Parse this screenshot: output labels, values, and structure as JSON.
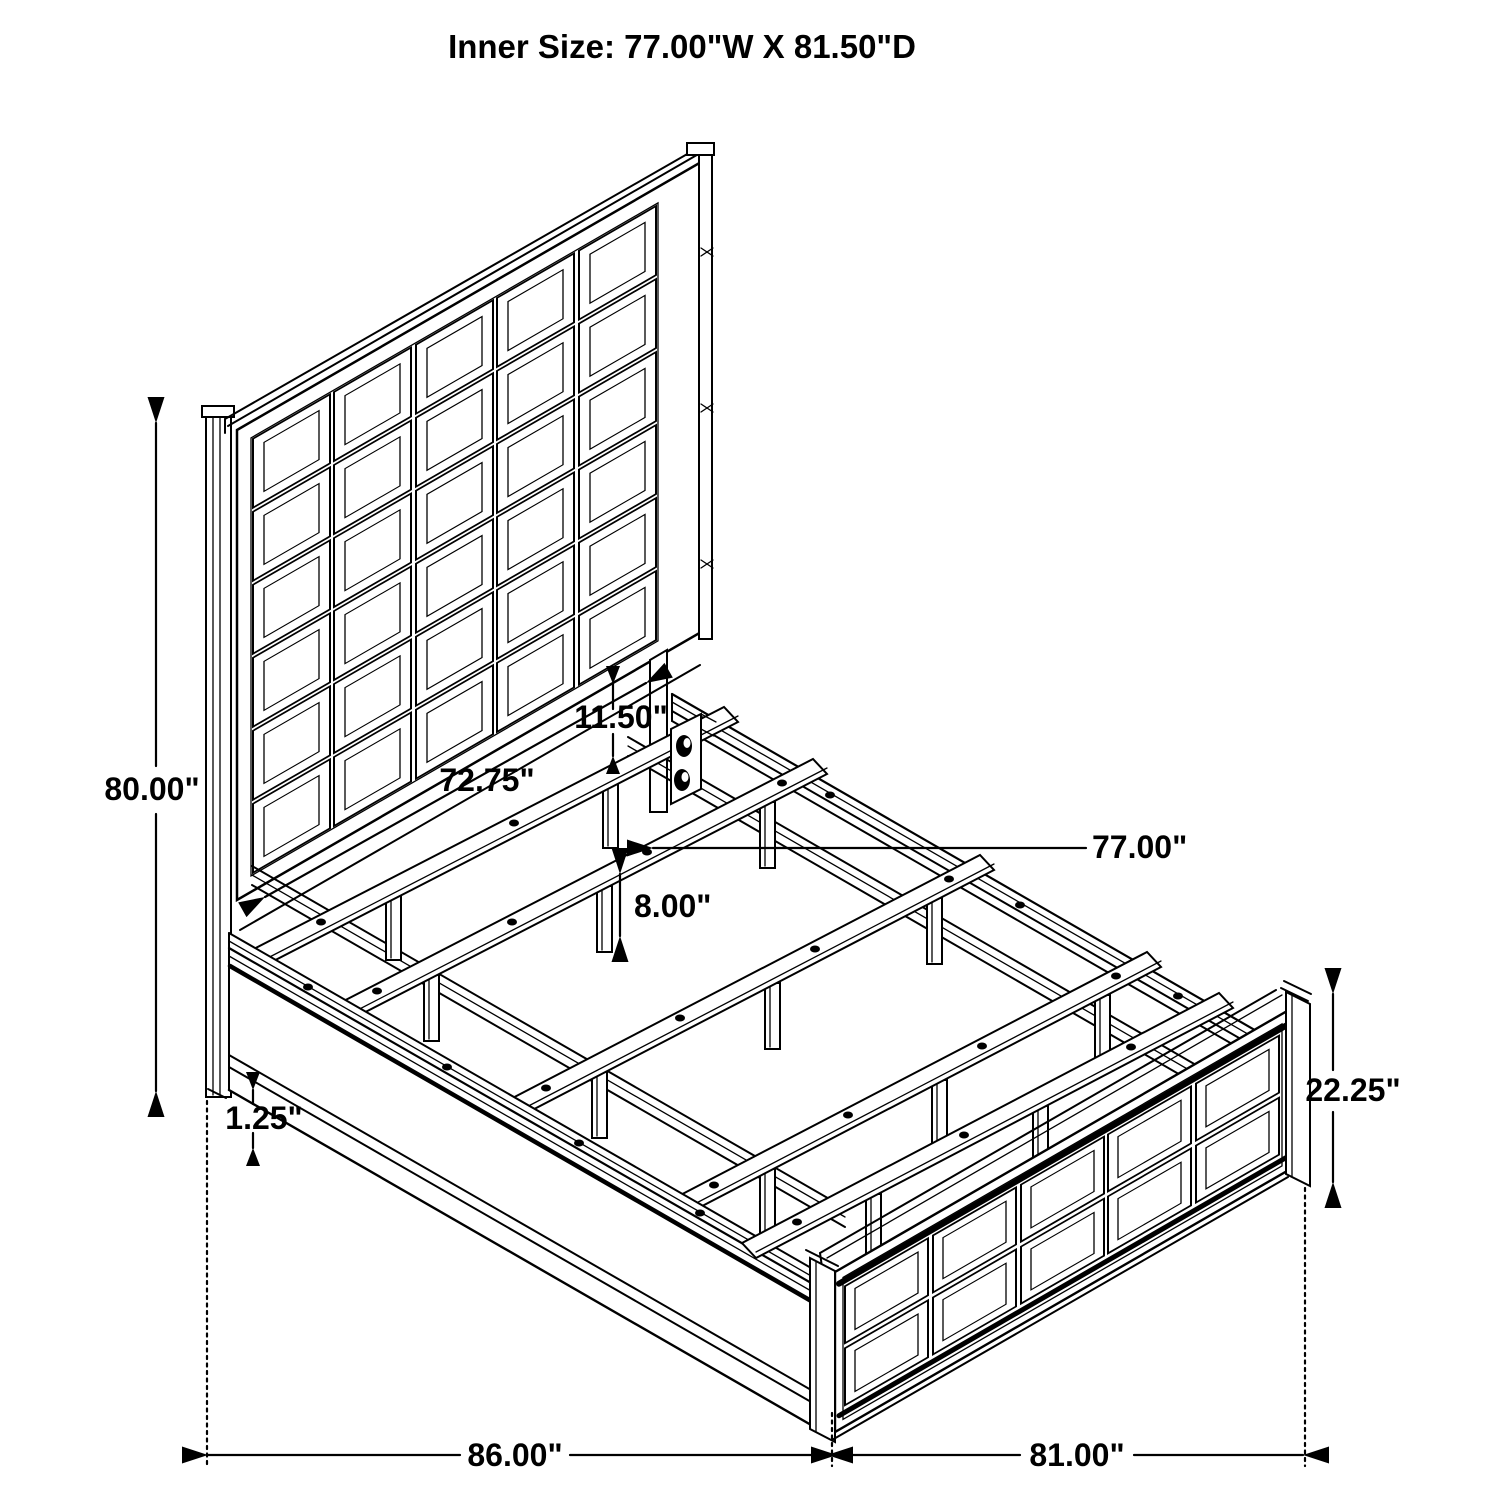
{
  "title": "Inner Size: 77.00\"W X 81.50\"D",
  "dimensions": {
    "overall_height": "80.00\"",
    "headboard_width": "72.75\"",
    "panel_to_rail_gap": "11.50\"",
    "slat_leg_height": "8.00\"",
    "inner_width": "77.00\"",
    "footboard_height": "22.25\"",
    "base_clearance": "1.25\"",
    "overall_depth": "86.00\"",
    "overall_width": "81.00\""
  },
  "colors": {
    "line": "#000000",
    "background": "#ffffff"
  }
}
